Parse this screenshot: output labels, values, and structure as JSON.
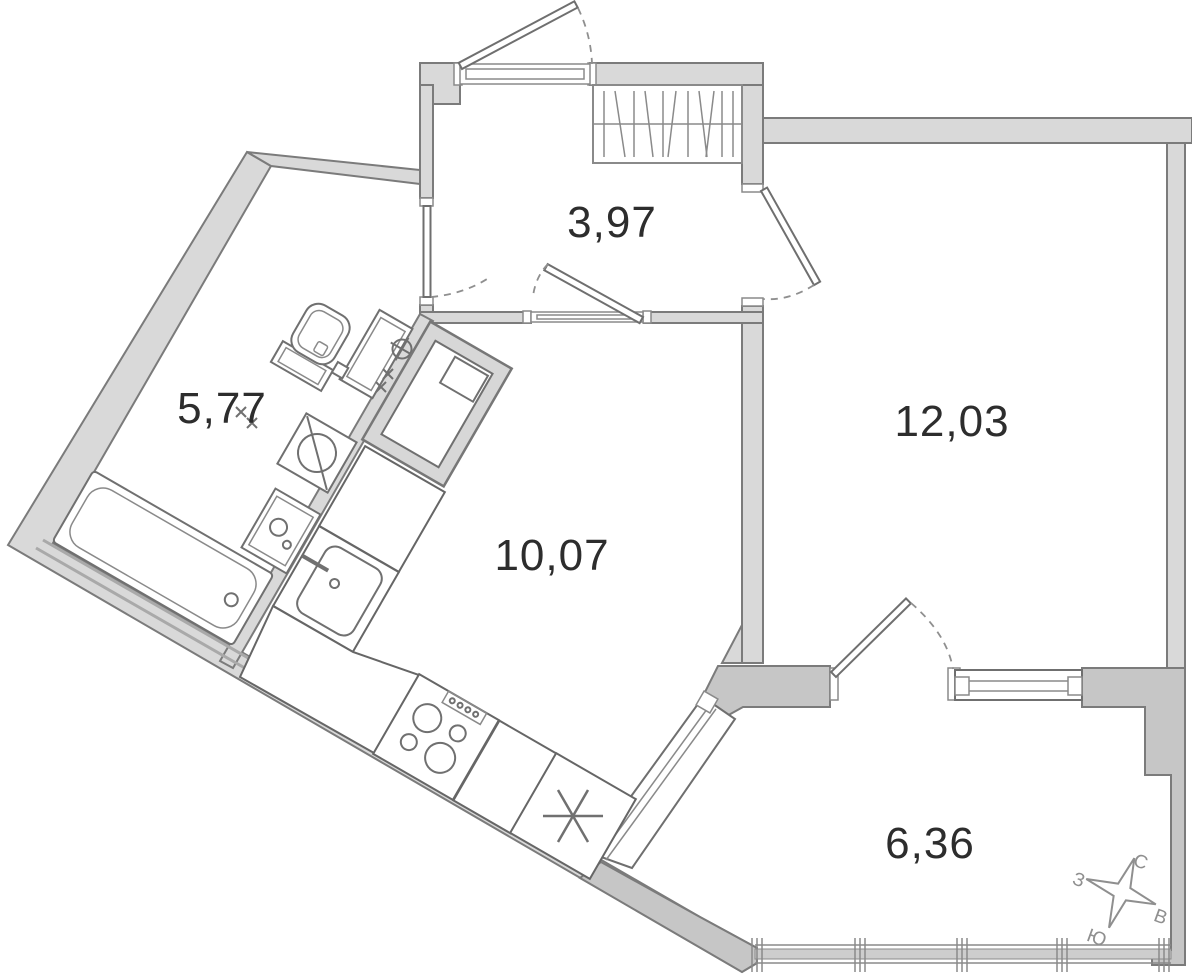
{
  "page": {
    "title": "Apartment floor plan"
  },
  "rooms": [
    {
      "id": "hallway",
      "area_label": "3,97"
    },
    {
      "id": "bathroom",
      "area_label": "5,77"
    },
    {
      "id": "kitchen-living-room",
      "area_label": "10,07"
    },
    {
      "id": "bedroom",
      "area_label": "12,03"
    },
    {
      "id": "balcony",
      "area_label": "6,36"
    }
  ],
  "compass": {
    "north_label": "С",
    "east_label": "В",
    "south_label": "Ю",
    "west_label": "З"
  },
  "fixtures": [
    "entry-door",
    "wardrobe",
    "toilet",
    "water-risers",
    "washing-machine",
    "bathroom-sink",
    "bathtub",
    "vent-shaft",
    "kitchen-counter",
    "kitchen-sink",
    "stove",
    "fridge-symbol",
    "bathroom-door",
    "kitchen-door",
    "bedroom-door",
    "balcony-door",
    "window",
    "balcony-glazing",
    "compass-rose"
  ],
  "colors": {
    "wall_light": "#d9d9d9",
    "wall_dark": "#c6c6c6",
    "outline": "#7b7b7b",
    "fixture": "#707070",
    "label_text": "#2d2d2d",
    "compass": "#8f8f8f",
    "background": "#ffffff"
  }
}
